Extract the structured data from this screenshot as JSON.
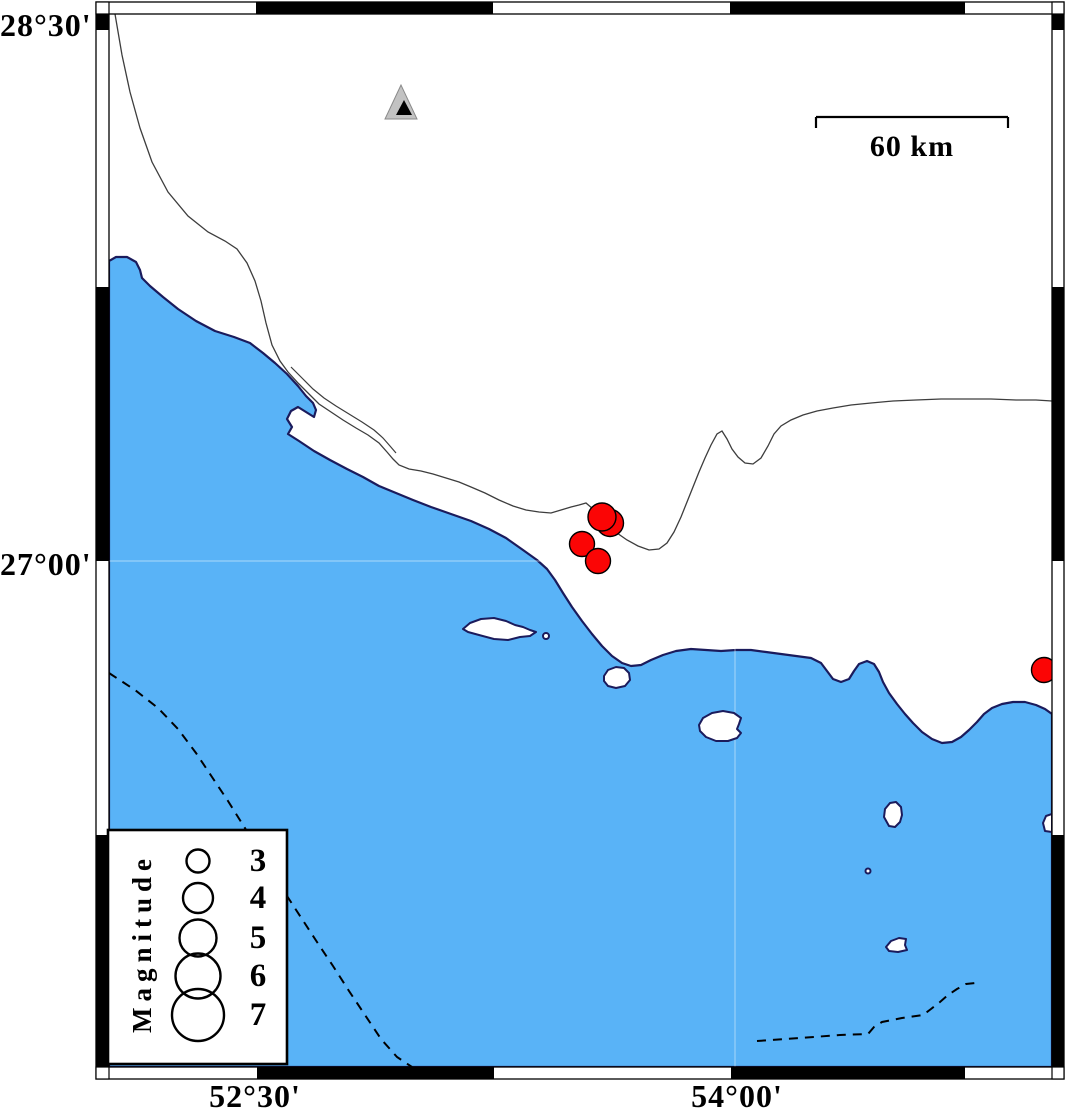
{
  "figure": {
    "type": "seismicity-map",
    "axis": {
      "lat_labels": [
        {
          "text": "28°30'",
          "tick_y": 13
        },
        {
          "text": "27°00'",
          "tick_y": 561
        }
      ],
      "lon_labels": [
        {
          "text": "52°30'",
          "tick_x": 255
        },
        {
          "text": "54°00'",
          "tick_x": 737
        }
      ]
    },
    "scale_bar": {
      "label": "60 km",
      "x1": 816,
      "x2": 1008,
      "y": 117,
      "tick_len": 11
    },
    "legend": {
      "title": "Magnitude",
      "circle_cx": 198,
      "box": {
        "x": 108,
        "y": 830,
        "w": 179,
        "h": 234
      },
      "entries": [
        {
          "label": "3",
          "cy": 861,
          "r": 11.5
        },
        {
          "label": "4",
          "cy": 898,
          "r": 15
        },
        {
          "label": "5",
          "cy": 938,
          "r": 18.5
        },
        {
          "label": "6",
          "cy": 976,
          "r": 22.5
        },
        {
          "label": "7",
          "cy": 1015,
          "r": 26
        }
      ]
    },
    "colors": {
      "sea": "#59B3F7",
      "coast": "#1b1b5c",
      "earthquake": "#FB0505",
      "station_fill": "#C2C2C2",
      "station_edge": "#8a8a8a",
      "border_line": "#3d3d3d",
      "black": "#000000",
      "white": "#ffffff"
    },
    "earthquakes": [
      {
        "x": 610,
        "y": 523,
        "r": 13.5
      },
      {
        "x": 602,
        "y": 517,
        "r": 14
      },
      {
        "x": 582,
        "y": 544,
        "r": 12.5
      },
      {
        "x": 598,
        "y": 561,
        "r": 12.5
      },
      {
        "x": 1044,
        "y": 670,
        "r": 12.5
      }
    ],
    "station": {
      "outer_points": "401,85 385,119 417,119",
      "inner_points": "404,100 396,115 412,115"
    },
    "frame": {
      "outer": {
        "x": 96,
        "y": 2,
        "w": 968,
        "h": 1077
      },
      "inner": {
        "x": 109,
        "y": 14,
        "w": 943,
        "h": 1053
      },
      "black_segments": [
        {
          "x": 256,
          "y": 2,
          "w": 237,
          "h": 12
        },
        {
          "x": 730,
          "y": 2,
          "w": 235,
          "h": 12
        },
        {
          "x": 257,
          "y": 1067,
          "w": 237,
          "h": 12
        },
        {
          "x": 731,
          "y": 1067,
          "w": 234,
          "h": 12
        },
        {
          "x": 96,
          "y": 14,
          "w": 13,
          "h": 16
        },
        {
          "x": 96,
          "y": 287,
          "w": 13,
          "h": 274
        },
        {
          "x": 96,
          "y": 835,
          "w": 13,
          "h": 232
        },
        {
          "x": 1052,
          "y": 14,
          "w": 12,
          "h": 16
        },
        {
          "x": 1052,
          "y": 287,
          "w": 12,
          "h": 274
        },
        {
          "x": 1052,
          "y": 835,
          "w": 12,
          "h": 232
        }
      ],
      "corner_squares": [
        {
          "x": 96,
          "y": 2,
          "w": 13,
          "h": 12
        },
        {
          "x": 1052,
          "y": 2,
          "w": 12,
          "h": 12
        },
        {
          "x": 96,
          "y": 1067,
          "w": 13,
          "h": 12
        },
        {
          "x": 1052,
          "y": 1067,
          "w": 12,
          "h": 12
        }
      ]
    },
    "gridlines": {
      "vertical_x": 735,
      "horizontal_y": 561
    },
    "geo": {
      "sea_path": "M 109 261 L 116 257 L 127 257 L 136 262 L 140 270 L 142 278 L 150 286 L 163 297 L 178 309 L 196 321 L 215 331 L 234 337 L 250 343 L 263 353 L 275 363 L 287 374 L 298 386 L 306 396 L 313 403 L 316 410 L 314 417 L 306 412 L 298 407 L 291 411 L 287 419 L 292 427 L 288 434 L 299 441 L 314 451 L 330 460 L 347 469 L 363 477 L 379 486 L 396 493 L 413 500 L 431 507 L 451 514 L 471 521 L 489 529 L 506 538 L 523 550 L 537 560 L 547 569 L 555 580 L 563 593 L 572 607 L 582 621 L 592 634 L 602 646 L 612 656 L 622 663 L 631 666 L 641 665 L 651 660 L 663 655 L 676 651 L 691 649 L 706 650 L 721 651 L 736 650 L 751 650 L 766 652 L 781 654 L 796 656 L 811 658 L 821 663 L 827 671 L 833 679 L 841 682 L 849 679 L 854 671 L 859 664 L 867 661 L 874 664 L 879 672 L 883 682 L 889 693 L 897 704 L 905 714 L 913 723 L 922 732 L 932 739 L 942 743 L 952 742 L 961 737 L 969 730 L 977 722 L 984 714 L 992 708 L 1002 704 L 1013 702 L 1025 702 L 1036 705 L 1045 709 L 1052 714 L 1052 1067 L 109 1067 Z",
      "islands": [
        {
          "kind": "path",
          "d": "M 463 629 L 470 623 L 481 619 L 494 618 L 506 621 L 515 625 L 523 627 L 530 630 L 536 632 L 530 636 L 520 637 L 508 640 L 494 639 L 479 635 L 468 632 Z"
        },
        {
          "kind": "circle",
          "cx": 546,
          "cy": 636,
          "r": 3
        },
        {
          "kind": "path",
          "d": "M 604 676 L 608 670 L 616 667 L 624 668 L 629 673 L 630 680 L 625 686 L 616 688 L 608 686 L 604 681 Z"
        },
        {
          "kind": "path",
          "d": "M 699 725 L 703 718 L 712 713 L 723 711 L 734 713 L 741 718 L 739 724 L 737 729 L 741 733 L 737 738 L 728 741 L 716 741 L 706 737 L 700 731 Z"
        },
        {
          "kind": "path",
          "d": "M 884 817 L 885 809 L 890 803 L 896 802 L 901 807 L 902 815 L 900 822 L 895 827 L 889 826 Z"
        },
        {
          "kind": "circle",
          "cx": 868,
          "cy": 871,
          "r": 2.5
        },
        {
          "kind": "path",
          "d": "M 886 947 L 891 941 L 899 938 L 906 939 L 905 945 L 907 950 L 898 952 L 889 951 Z"
        },
        {
          "kind": "path",
          "d": "M 1045 831 L 1043 823 L 1046 816 L 1052 814 L 1052 832 Z"
        }
      ],
      "border_line": "M 115 14 L 122 55 L 130 92 L 140 128 L 152 162 L 168 192 L 188 216 L 208 232 L 225 241 L 237 249 L 247 263 L 255 281 L 261 301 L 266 323 L 272 345 L 280 361 L 288 372 L 298 383 L 309 394 L 319 404 L 331 412 L 343 420 L 356 428 L 368 435 L 379 443 L 387 452 L 393 459 L 399 465 L 409 469 L 421 471 L 433 474 L 446 478 L 459 482 L 471 487 L 485 493 L 499 500 L 513 506 L 526 510 L 539 512 L 551 513 L 561 510 L 571 507 L 579 505 L 586 503 L 593 509 L 601 517 L 609 525 L 617 533 L 627 540 L 638 546 L 649 550 L 659 549 L 667 543 L 674 532 L 681 517 L 687 502 L 693 487 L 699 472 L 705 458 L 711 445 L 717 434 L 722 431 L 727 439 L 732 449 L 738 457 L 745 463 L 753 464 L 761 458 L 768 446 L 774 434 L 781 426 L 791 420 L 803 415 L 817 411 L 833 408 L 851 405 L 871 403 L 893 401 L 916 400 L 941 399 L 966 399 L 991 399 L 1016 400 L 1036 400 L 1052 401",
      "border_line_2": "M 291 367 L 302 378 L 313 389 L 324 398 L 336 406 L 349 414 L 362 422 L 374 430 L 383 438 L 390 446 L 396 453",
      "dashed_lines": [
        "M 109 673 L 135 690 L 158 708 L 178 729 L 196 753 L 212 777 L 228 801 L 243 825 L 258 849 L 272 872 L 287 896 L 302 919 L 317 942 L 333 966 L 349 991 L 365 1015 L 381 1039 L 397 1057 L 412 1067",
        "M 757 1041 L 800 1038 L 840 1035 L 868 1034 L 874 1027 L 882 1022 L 902 1018 L 923 1015 L 931 1009 L 940 1002 L 948 995 L 957 989 L 966 984 L 975 983"
      ]
    }
  }
}
